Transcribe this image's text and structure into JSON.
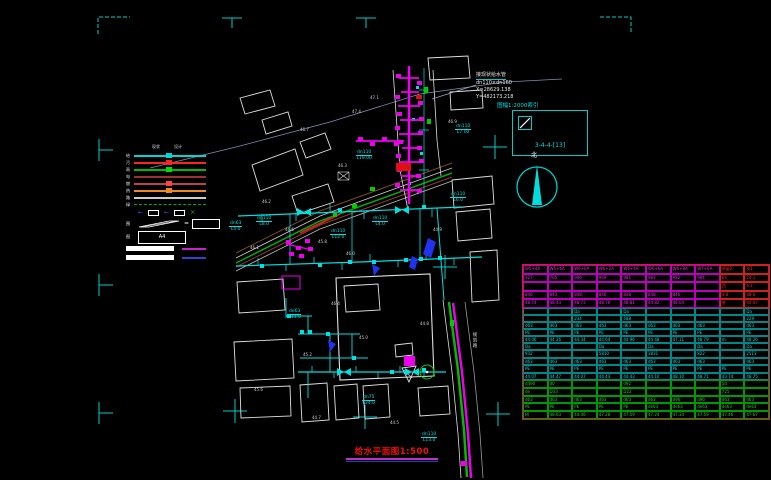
{
  "app": {
    "background": "#000000",
    "mark_color": "#00cccc"
  },
  "legend": {
    "headers": [
      "现状",
      "设计"
    ],
    "rows": [
      {
        "label": "给",
        "color": "#00d5d5",
        "dashed": false,
        "marker": "#00d5d5"
      },
      {
        "label": "污",
        "color": "#ff2222",
        "dashed": false,
        "marker": "#ff2222"
      },
      {
        "label": "雨",
        "color": "#00bb00",
        "dashed": false,
        "marker": "#00dd00"
      },
      {
        "label": "电",
        "color": "#993333",
        "dashed": false,
        "marker": null
      },
      {
        "label": "燃",
        "color": "#bb4444",
        "dashed": false,
        "marker": "#ff4444"
      },
      {
        "label": "热",
        "color": "#ee8822",
        "dashed": false,
        "marker": "#ee8822"
      },
      {
        "label": "路",
        "color": "#cccccc",
        "dashed": false,
        "marker": null
      },
      {
        "label": "绿",
        "color": "#00aa00",
        "dashed": true,
        "marker": null
      }
    ],
    "symbols": [
      {
        "type": "arrow",
        "color": "#4455ff"
      },
      {
        "type": "box",
        "color": "#ffffff"
      },
      {
        "type": "arrow",
        "color": "#4455ff"
      },
      {
        "type": "box",
        "color": "#ffffff"
      },
      {
        "type": "x",
        "color": "#00cc00"
      }
    ],
    "area_label": "围",
    "eq": "=",
    "frame_label": "图",
    "a4": "A4",
    "accent1": "#cc22cc",
    "accent2": "#3344cc"
  },
  "annotations": {
    "connect_note": [
      "接现状给水管",
      "dn110×dn160",
      "X=28629.138",
      "Y=482173.218"
    ],
    "index_title": "图幅1:2000索引",
    "index_code": "3-4-4-[13]",
    "north": "北",
    "road_name": "规划路",
    "title": "给水平面图1:500"
  },
  "plan": {
    "pipe_labels": [
      {
        "d": "dn110",
        "l": "L7.00",
        "x": 455,
        "y": 124
      },
      {
        "d": "dn110",
        "l": "L19.00",
        "x": 356,
        "y": 150
      },
      {
        "d": "dn110",
        "l": "L8.0",
        "x": 256,
        "y": 216
      },
      {
        "d": "dn110",
        "l": "L4.0",
        "x": 372,
        "y": 216
      },
      {
        "d": "dn63",
        "l": "L5.0",
        "x": 229,
        "y": 221
      },
      {
        "d": "dn110",
        "l": "L6.0",
        "x": 450,
        "y": 192
      },
      {
        "d": "de63",
        "l": "L11.0",
        "x": 288,
        "y": 309
      },
      {
        "d": "dn75",
        "l": "L24.0",
        "x": 362,
        "y": 395
      },
      {
        "d": "dn110",
        "l": "L13.0",
        "x": 421,
        "y": 432
      },
      {
        "d": "dn110",
        "l": "L12.0",
        "x": 330,
        "y": 229
      }
    ],
    "spot_texts": [
      {
        "x": 262,
        "y": 200,
        "t": "46.2"
      },
      {
        "x": 318,
        "y": 240,
        "t": "45.8"
      },
      {
        "x": 346,
        "y": 252,
        "t": "46.0"
      },
      {
        "x": 433,
        "y": 228,
        "t": "44.9"
      },
      {
        "x": 303,
        "y": 353,
        "t": "45.2"
      },
      {
        "x": 331,
        "y": 302,
        "t": "46.4"
      },
      {
        "x": 359,
        "y": 336,
        "t": "45.0"
      },
      {
        "x": 420,
        "y": 322,
        "t": "44.8"
      },
      {
        "x": 254,
        "y": 388,
        "t": "45.6"
      },
      {
        "x": 312,
        "y": 416,
        "t": "44.7"
      },
      {
        "x": 390,
        "y": 421,
        "t": "44.5"
      },
      {
        "x": 285,
        "y": 228,
        "t": "46.6"
      },
      {
        "x": 250,
        "y": 246,
        "t": "46.1"
      },
      {
        "x": 370,
        "y": 96,
        "t": "47.1"
      },
      {
        "x": 352,
        "y": 110,
        "t": "47.4"
      },
      {
        "x": 448,
        "y": 120,
        "t": "46.9"
      },
      {
        "x": 300,
        "y": 128,
        "t": "46.7"
      },
      {
        "x": 338,
        "y": 164,
        "t": "46.3"
      }
    ]
  },
  "table": {
    "outer_border": "#cc2222",
    "sections": [
      {
        "name": "stations",
        "border": "#bb00bb",
        "text": "#ee22ee",
        "red_text": "#ff2222",
        "red_cols": [
          8,
          9
        ],
        "row_h": 8.6,
        "rows": [
          [
            "W5+4A",
            "W5+6A",
            "W6+0A",
            "W6+2A",
            "W6+4A",
            "W6+6A",
            "W6+8A",
            "W7+0A",
            "预留2",
            "支1"
          ],
          [
            "327",
            "765",
            "946",
            "949",
            "981",
            "981",
            "982",
            "984",
            "64",
            "24.1"
          ],
          [
            "",
            "",
            "",
            "",
            "",
            "",
            "",
            "",
            "西",
            "4.1"
          ],
          [
            "846",
            "843",
            "848",
            "846",
            "848",
            "848",
            "846",
            "",
            "4.8",
            "48.0"
          ],
          [
            "48.74",
            "48.43",
            "48.73",
            "48.76",
            "48.81",
            "44.82",
            "48.04",
            "",
            "参",
            "44.07"
          ]
        ]
      },
      {
        "name": "pipe-run-a",
        "border": "#008888",
        "text": "#00dddd",
        "row_h": 7,
        "rows": [
          [
            "",
            "",
            "Da",
            "",
            "Da",
            "",
            "",
            "",
            "",
            "Da"
          ],
          [
            "",
            "",
            "234",
            "",
            "588",
            "",
            "",
            "",
            "",
            "229"
          ],
          [
            "d63",
            "d63",
            "d63",
            "d63",
            "d63",
            "d63",
            "d63",
            "d63",
            "",
            "d63"
          ],
          [
            "PE",
            "PE",
            "PE",
            "PE",
            "PE",
            "PE",
            "PE",
            "PE",
            "",
            "PE"
          ],
          [
            "44.06",
            "44.26",
            "44.34",
            "44.64",
            "44.96",
            "44.48",
            "47.11",
            "48.79",
            "m",
            "48.26"
          ]
        ]
      },
      {
        "name": "pipe-run-b",
        "border": "#008888",
        "text": "#00dddd",
        "row_h": 7.4,
        "rows": [
          [
            "Da",
            "",
            "",
            "Da",
            "",
            "Da",
            "",
            "Da",
            "",
            "Da"
          ],
          [
            "932",
            "",
            "",
            "5810",
            "",
            "3831",
            "",
            "822",
            "",
            "2513"
          ],
          [
            "d63",
            "d63",
            "d63",
            "d63",
            "d63",
            "d63",
            "d63",
            "d63",
            "",
            "d63"
          ],
          [
            "PE",
            "PE",
            "PE",
            "PE",
            "PE",
            "PE",
            "PE",
            "PE",
            "PE",
            "PE"
          ],
          [
            "44.07",
            "44.47",
            "44.07",
            "44.43",
            "44.43",
            "44.10",
            "48.10",
            "48.71",
            "43.74",
            "48.75"
          ]
        ]
      },
      {
        "name": "ground",
        "border": "#009900",
        "text": "#22cc22",
        "row_h": 7.8,
        "rows": [
          [
            "d490",
            "d0",
            "",
            "",
            "d92",
            "",
            "",
            "",
            "5d",
            ""
          ],
          [
            "de",
            "D33",
            "",
            "",
            "D22",
            "",
            "",
            "",
            "725",
            ""
          ],
          [
            "d63",
            "d63",
            "d63",
            "d63",
            "d63",
            "d63",
            "d96",
            "d96",
            "d63",
            "d63"
          ],
          [
            "PE",
            "PE",
            "PE",
            "PE",
            "PE",
            "de63",
            "de63",
            "de63",
            "de63",
            "de63"
          ],
          [
            "树",
            "48.63",
            "44.46",
            "47.28",
            "47.59",
            "47.24",
            "47.34",
            "47.59",
            "47.46",
            "47.67"
          ]
        ]
      }
    ]
  }
}
